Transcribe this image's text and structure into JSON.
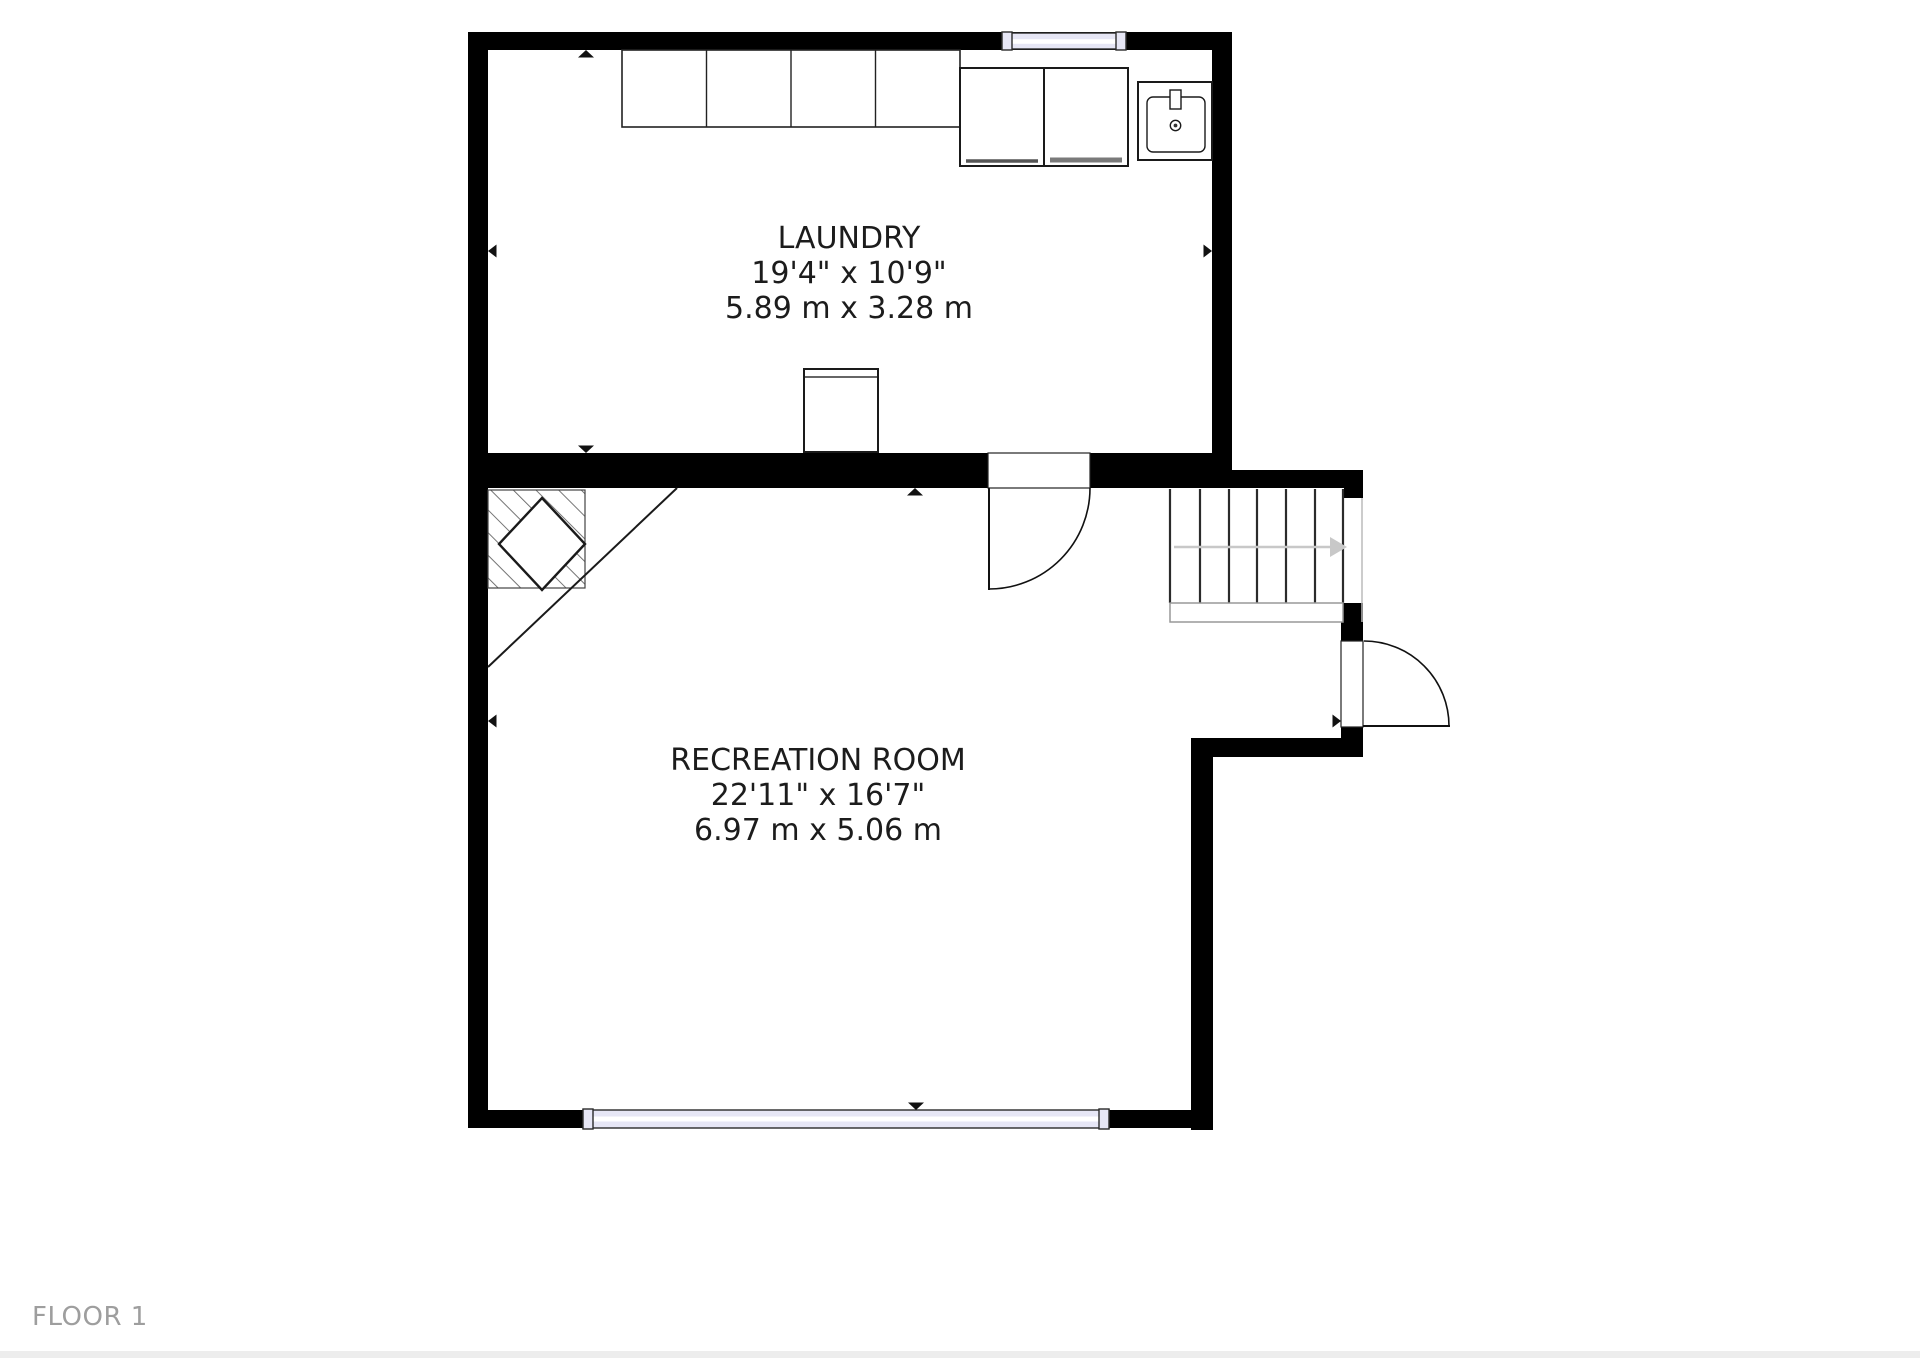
{
  "floor": {
    "label": "FLOOR 1"
  },
  "rooms": [
    {
      "name": "LAUNDRY",
      "dimensions_imperial": "19'4\" x 10'9\"",
      "dimensions_metric": "5.89 m x 3.28 m"
    },
    {
      "name": "RECREATION ROOM",
      "dimensions_imperial": "22'11\" x 16'7\"",
      "dimensions_metric": "6.97 m x 5.06 m"
    }
  ],
  "colors": {
    "wall": "#000000",
    "window_glass": "#e6e6f5",
    "room_label_text": "#1c1c1c",
    "floor_label_text": "#9e9e9e",
    "stair_arrow": "#c8c8c8",
    "fixture_outline": "#1a1a1a",
    "footer_strip": "#ededed"
  }
}
